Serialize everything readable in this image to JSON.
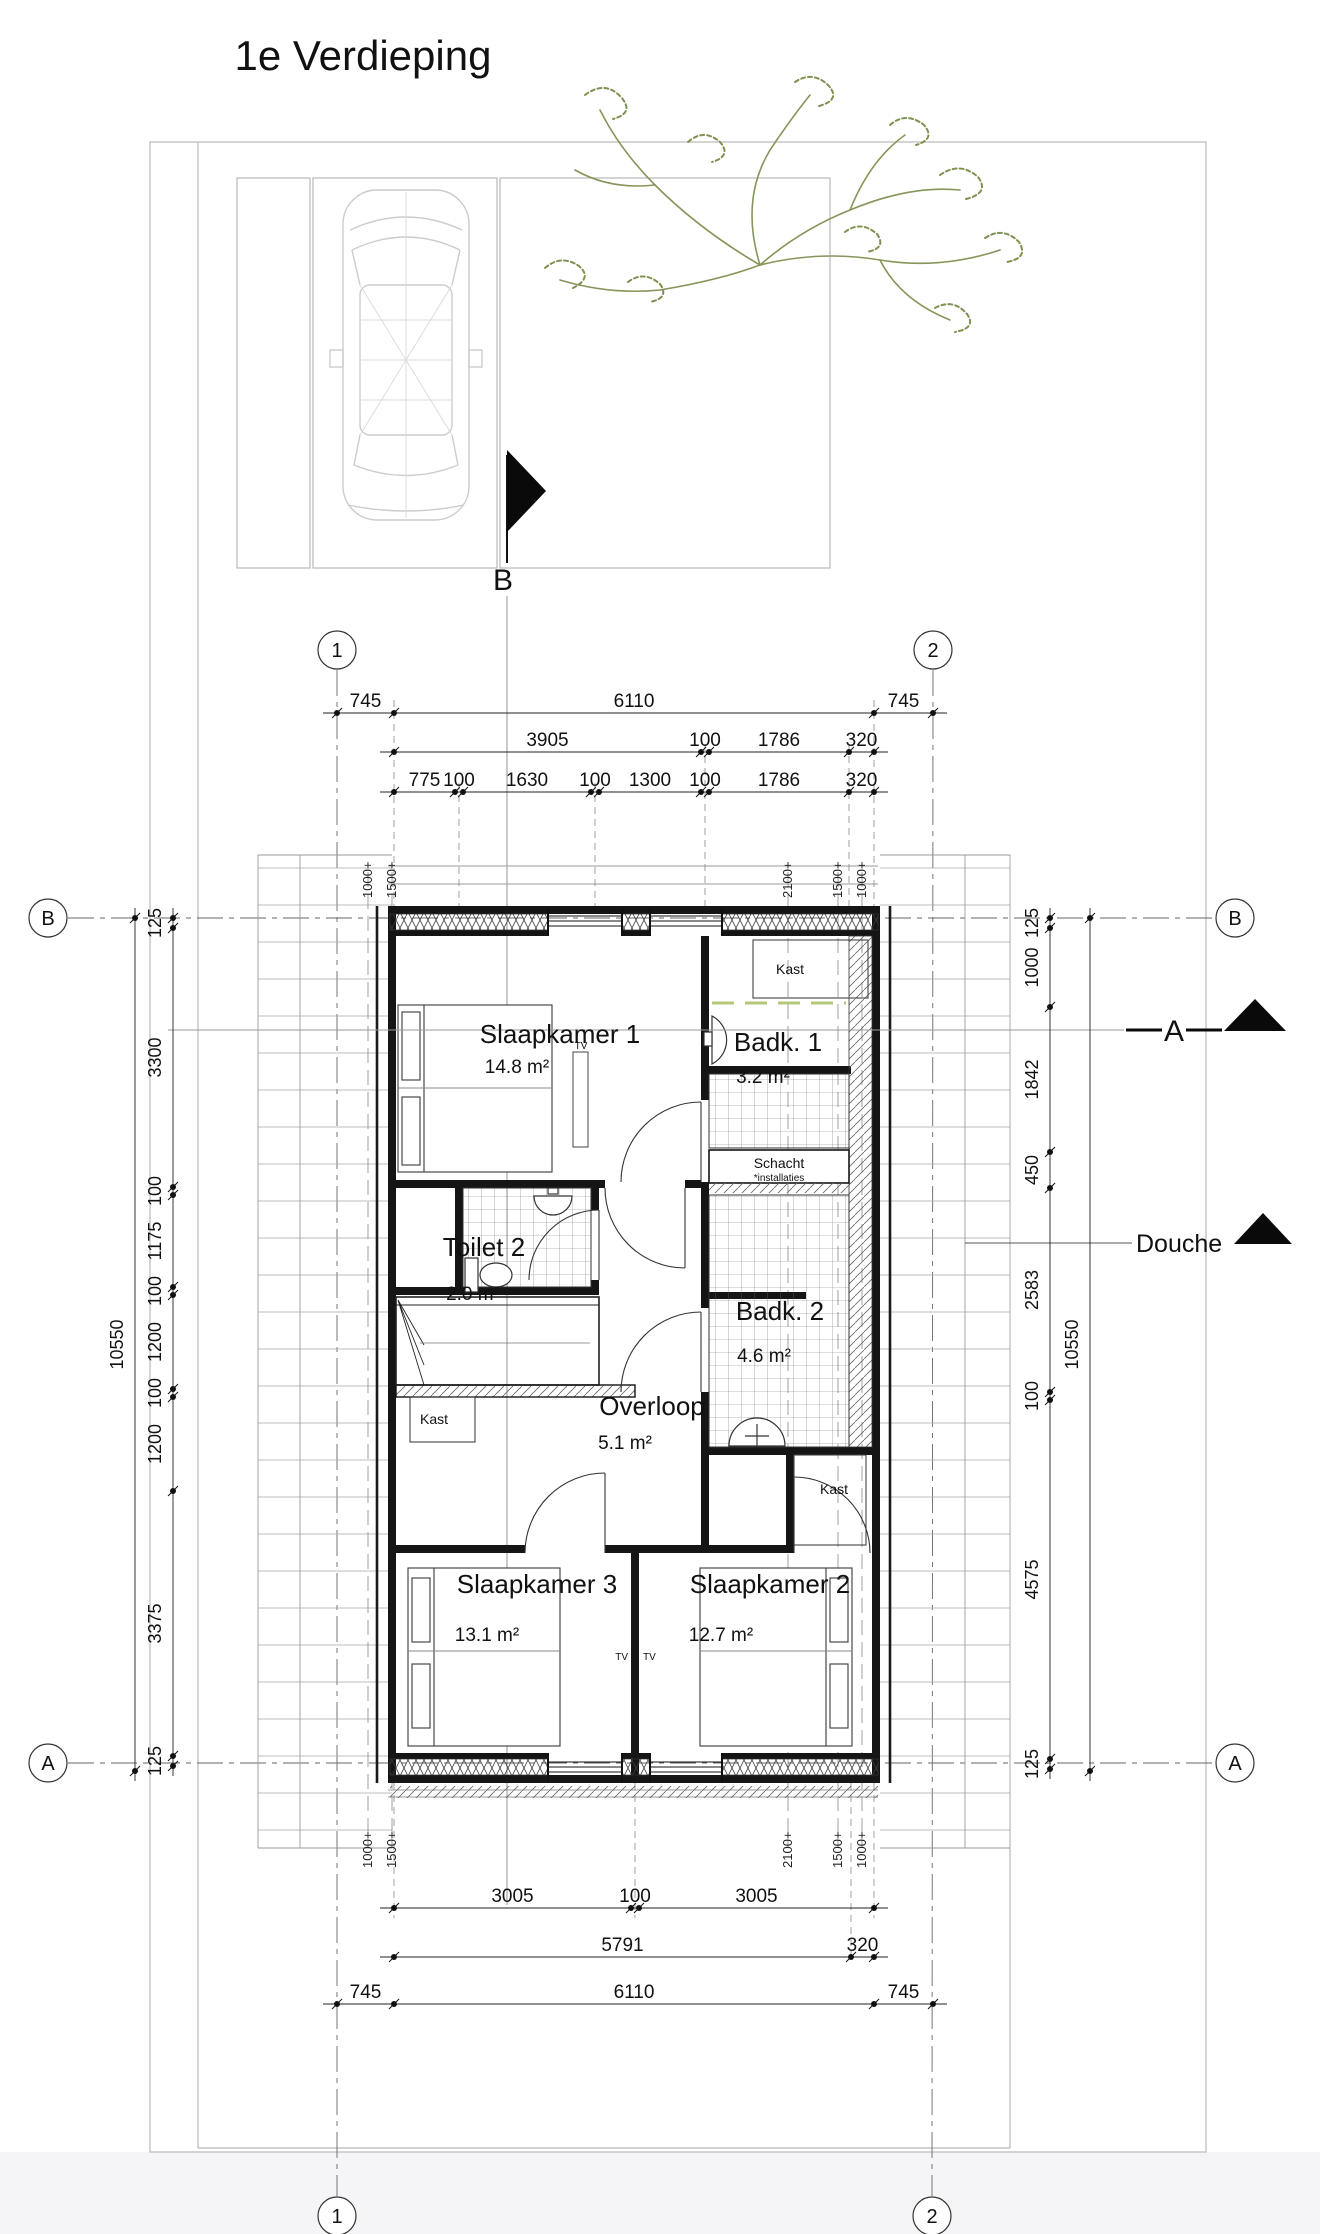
{
  "title": "1e Verdieping",
  "plan": {
    "rooms": [
      {
        "id": "slaapkamer-1",
        "name": "Slaapkamer 1",
        "area": "14.8 m²"
      },
      {
        "id": "badkamer-1",
        "name": "Badk. 1",
        "area": "3.2 m²"
      },
      {
        "id": "toilet-2",
        "name": "Toilet 2",
        "area": "2.0 m²"
      },
      {
        "id": "badkamer-2",
        "name": "Badk. 2",
        "area": "4.6 m²"
      },
      {
        "id": "overloop",
        "name": "Overloop",
        "area": "5.1 m²"
      },
      {
        "id": "slaapkamer-3",
        "name": "Slaapkamer 3",
        "area": "13.1 m²"
      },
      {
        "id": "slaapkamer-2",
        "name": "Slaapkamer 2",
        "area": "12.7 m²"
      }
    ],
    "labels": {
      "kast": "Kast",
      "schacht": "Schacht",
      "installaties": "*installaties",
      "tv": "TV",
      "douche": "Douche"
    },
    "sections": {
      "a": "A",
      "b": "B"
    }
  },
  "grid": {
    "cols": [
      "1",
      "2"
    ],
    "rows": [
      "B",
      "A"
    ]
  },
  "height_markers": {
    "top": [
      "1000+",
      "1500+",
      "2100+",
      "1500+",
      "1000+"
    ],
    "bottom": [
      "1000+",
      "1500+",
      "2100+",
      "1500+",
      "1000+"
    ]
  },
  "dimensions": {
    "top": [
      [
        "745",
        "6110",
        "745"
      ],
      [
        "3905",
        "100",
        "1786",
        "320"
      ],
      [
        "775",
        "100",
        "1630",
        "100",
        "1300",
        "100",
        "1786",
        "320"
      ]
    ],
    "bottom": [
      [
        "3005",
        "100",
        "3005"
      ],
      [
        "5791",
        "320"
      ],
      [
        "745",
        "6110",
        "745"
      ]
    ],
    "left": {
      "outer": [
        "10550"
      ],
      "chain": [
        "125",
        "3300",
        "100",
        "1175",
        "100",
        "1200",
        "100",
        "1200",
        "3375",
        "125"
      ]
    },
    "right": {
      "outer": [
        "10550"
      ],
      "chain": [
        "125",
        "1000",
        "1842",
        "450",
        "2583",
        "100",
        "4575",
        "125"
      ]
    }
  },
  "colors": {
    "wall": "#151515",
    "line": "#555555",
    "site": "#c3c3c3",
    "roof": "#a0a0a0",
    "car": "#cccccc",
    "tree": "#86955a",
    "accent_green": "#b5c87a"
  }
}
